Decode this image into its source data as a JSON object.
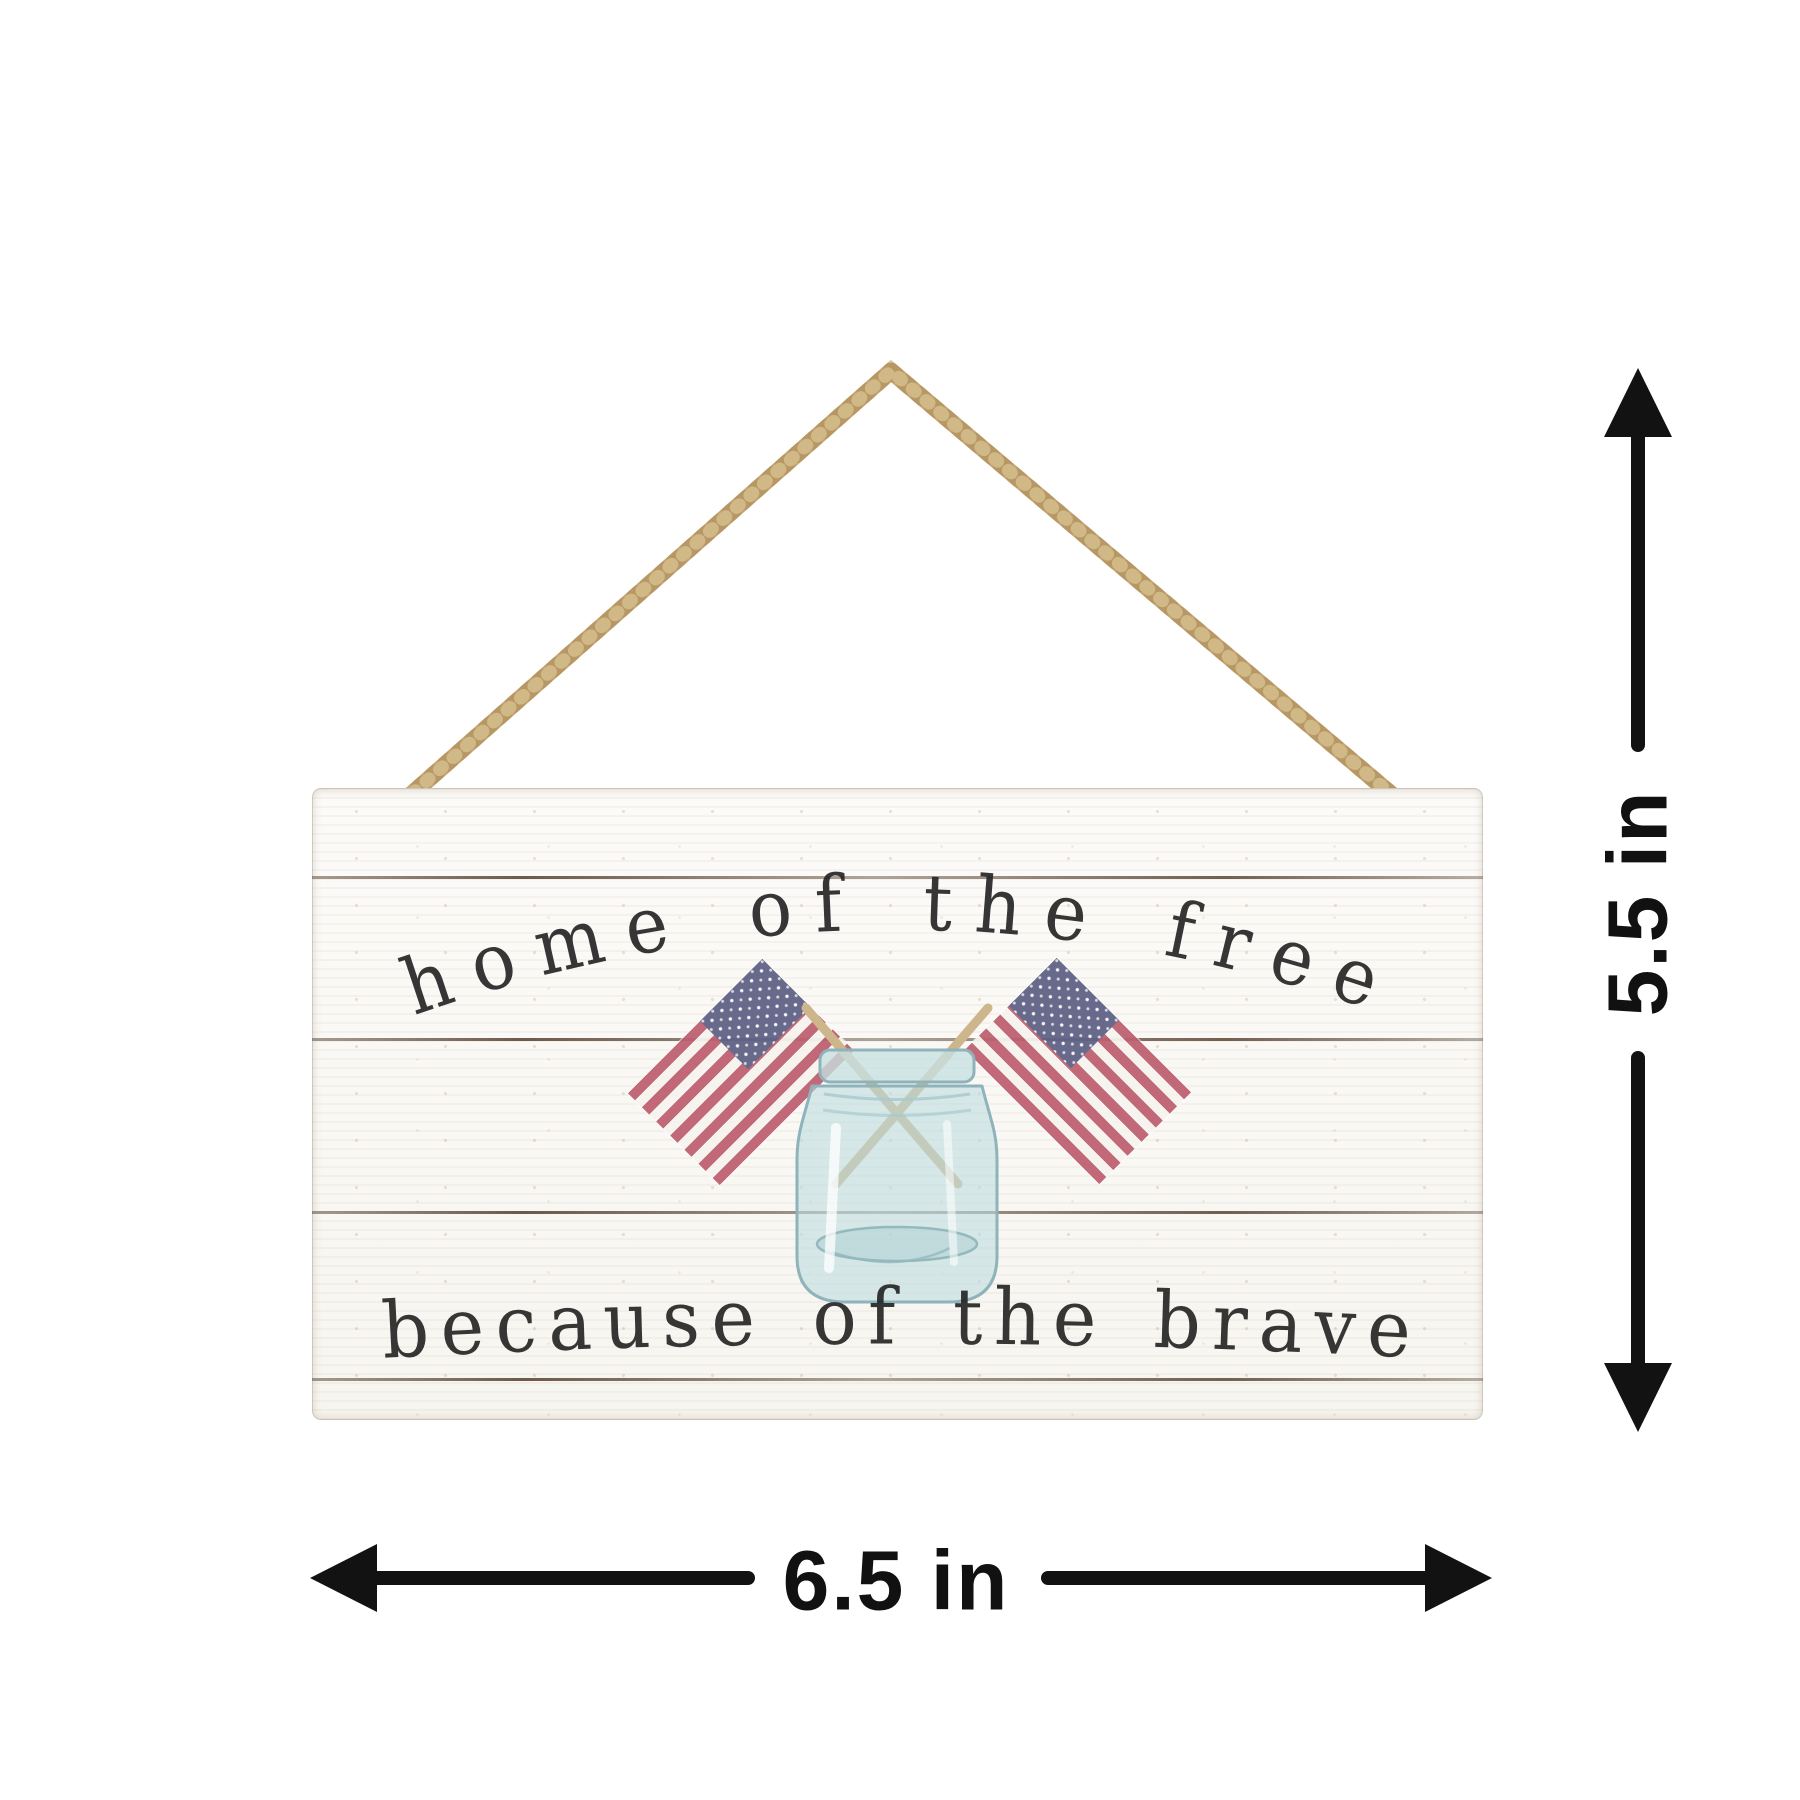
{
  "product": {
    "type": "hanging wood sign product photo with size annotations",
    "sign": {
      "top_text": "home of the free",
      "bottom_text": "because of the brave",
      "planks": 5,
      "artwork": [
        "american-flag-left",
        "american-flag-right",
        "mason-jar",
        "jute-rope"
      ]
    }
  },
  "dimensions": {
    "height_label": "5.5 in",
    "width_label": "6.5 in"
  },
  "colors": {
    "background": "#ffffff",
    "sign_base": "#fbfaf7",
    "plank_seam": "#5a4431",
    "sign_text_ink": "#262626",
    "flag_red": "#bd5f6f",
    "flag_navy": "#5e6085",
    "flag_white": "#f7f4ef",
    "flag_stick_tan": "#cdb68c",
    "jar_glass": "#c7dfe1",
    "jar_outline": "#8fb3ba",
    "rope_tan": "#c6a777",
    "dimension_ink": "#111111"
  }
}
